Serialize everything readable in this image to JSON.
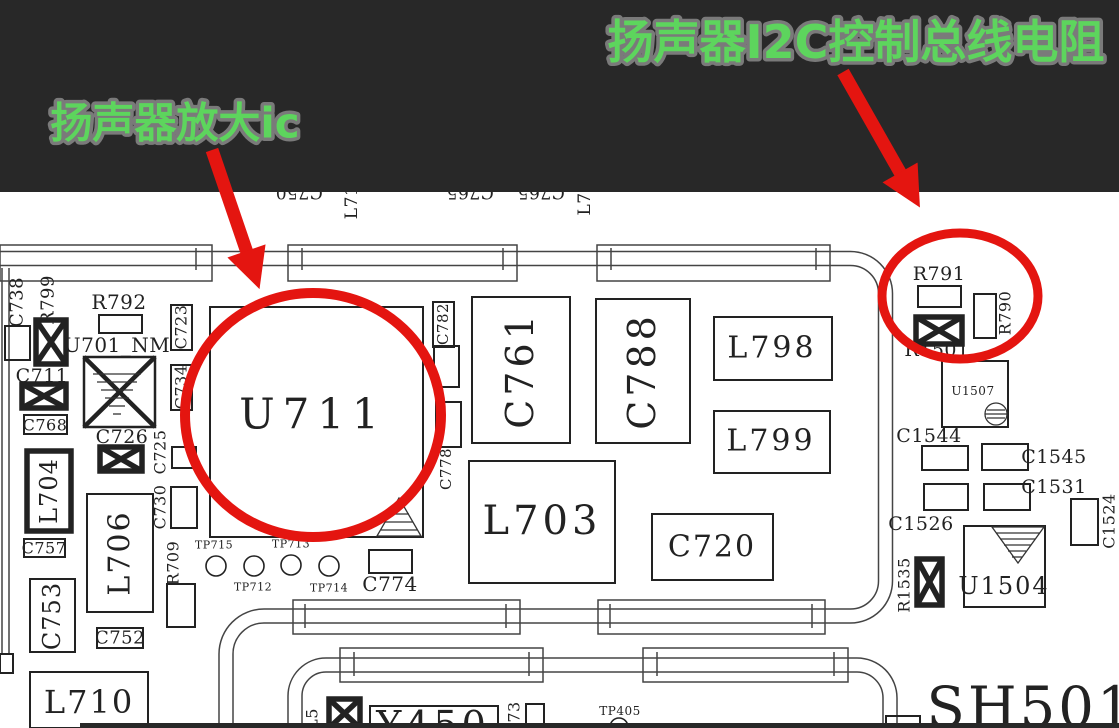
{
  "banner": {
    "left_label": "扬声器放大ic",
    "right_label": "扬声器I2C控制总线电阻",
    "bg": "#282828",
    "text_color": "#5dd55d",
    "outline_color": "#7a7a7a"
  },
  "pcb": {
    "bg": "#ffffff",
    "ink": "#222222",
    "trace_ink": "#444444",
    "pipes": [
      "M 0 258.5 H 850.5 A 35 35 0 0 1 885.5 293.5 V 581 A 35 35 0 0 1 850.5 616 H 264 A 38 38 0 0 0 226 654 V 728",
      "M 295 728 V 696 A 31 31 0 0 1 326 665 H 857 A 33 33 0 0 1 890 698 V 728"
    ],
    "bus_rects": [
      {
        "x": 0,
        "y": 245,
        "w": 212,
        "h": 36
      },
      {
        "x": 288,
        "y": 245,
        "w": 229,
        "h": 36
      },
      {
        "x": 597,
        "y": 245,
        "w": 233,
        "h": 36
      },
      {
        "x": 293,
        "y": 600,
        "w": 227,
        "h": 34
      },
      {
        "x": 598,
        "y": 600,
        "w": 227,
        "h": 34
      },
      {
        "x": 340,
        "y": 648,
        "w": 203,
        "h": 34
      },
      {
        "x": 643,
        "y": 648,
        "w": 205,
        "h": 34
      }
    ],
    "bus_ticks": [
      {
        "x": 196,
        "y1": 248,
        "y2": 270
      },
      {
        "x": 302,
        "y1": 248,
        "y2": 270
      },
      {
        "x": 503,
        "y1": 248,
        "y2": 270
      },
      {
        "x": 611,
        "y1": 248,
        "y2": 270
      },
      {
        "x": 816,
        "y1": 248,
        "y2": 270
      },
      {
        "x": 305,
        "y1": 604,
        "y2": 628
      },
      {
        "x": 506,
        "y1": 604,
        "y2": 628
      },
      {
        "x": 610,
        "y1": 604,
        "y2": 628
      },
      {
        "x": 812,
        "y1": 604,
        "y2": 628
      },
      {
        "x": 354,
        "y1": 652,
        "y2": 676
      },
      {
        "x": 529,
        "y1": 652,
        "y2": 676
      },
      {
        "x": 657,
        "y1": 652,
        "y2": 676
      },
      {
        "x": 834,
        "y1": 652,
        "y2": 676
      }
    ],
    "lines": [
      {
        "x1": 2,
        "y1": 268,
        "x2": 2,
        "y2": 655
      },
      {
        "x1": 9,
        "y1": 268,
        "x2": 9,
        "y2": 655
      }
    ],
    "boxes": [
      {
        "x": 5,
        "y": 326,
        "w": 25,
        "h": 34
      },
      {
        "x": 99,
        "y": 315,
        "w": 43,
        "h": 18
      },
      {
        "x": 24,
        "y": 415,
        "w": 43,
        "h": 19
      },
      {
        "x": 171,
        "y": 305,
        "w": 21,
        "h": 45
      },
      {
        "x": 171,
        "y": 365,
        "w": 21,
        "h": 45
      },
      {
        "x": 172,
        "y": 447,
        "w": 24,
        "h": 21
      },
      {
        "x": 24,
        "y": 539,
        "w": 41,
        "h": 18
      },
      {
        "x": 30,
        "y": 579,
        "w": 45,
        "h": 73
      },
      {
        "x": 87,
        "y": 494,
        "w": 66,
        "h": 118
      },
      {
        "x": 171,
        "y": 487,
        "w": 26,
        "h": 41
      },
      {
        "x": 167,
        "y": 584,
        "w": 28,
        "h": 43
      },
      {
        "x": 97,
        "y": 628,
        "w": 46,
        "h": 20
      },
      {
        "x": 30,
        "y": 672,
        "w": 118,
        "h": 56
      },
      {
        "x": 27,
        "y": 451,
        "w": 44,
        "h": 80,
        "lw": 5.5
      },
      {
        "x": 210,
        "y": 307,
        "w": 213,
        "h": 230
      },
      {
        "x": 369,
        "y": 550,
        "w": 43,
        "h": 23
      },
      {
        "x": 433,
        "y": 302,
        "w": 21,
        "h": 45
      },
      {
        "x": 434,
        "y": 346,
        "w": 25,
        "h": 41
      },
      {
        "x": 436,
        "y": 402,
        "w": 25,
        "h": 45
      },
      {
        "x": 472,
        "y": 297,
        "w": 98,
        "h": 146
      },
      {
        "x": 596,
        "y": 299,
        "w": 94,
        "h": 144
      },
      {
        "x": 469,
        "y": 461,
        "w": 146,
        "h": 122
      },
      {
        "x": 652,
        "y": 514,
        "w": 121,
        "h": 66
      },
      {
        "x": 714,
        "y": 317,
        "w": 118,
        "h": 63
      },
      {
        "x": 714,
        "y": 411,
        "w": 116,
        "h": 62
      },
      {
        "x": 918,
        "y": 286,
        "w": 43,
        "h": 21
      },
      {
        "x": 974,
        "y": 294,
        "w": 22,
        "h": 44
      },
      {
        "x": 942,
        "y": 361,
        "w": 66,
        "h": 66
      },
      {
        "x": 922,
        "y": 446,
        "w": 46,
        "h": 24
      },
      {
        "x": 924,
        "y": 484,
        "w": 44,
        "h": 26
      },
      {
        "x": 982,
        "y": 444,
        "w": 46,
        "h": 26
      },
      {
        "x": 984,
        "y": 484,
        "w": 46,
        "h": 26
      },
      {
        "x": 1071,
        "y": 499,
        "w": 27,
        "h": 46
      },
      {
        "x": 964,
        "y": 526,
        "w": 81,
        "h": 81
      },
      {
        "x": 370,
        "y": 706,
        "w": 128,
        "h": 40
      },
      {
        "x": 526,
        "y": 704,
        "w": 18,
        "h": 24
      },
      {
        "x": 886,
        "y": 716,
        "w": 34,
        "h": 12
      },
      {
        "x": 0,
        "y": 654,
        "w": 13,
        "h": 19
      }
    ],
    "xboxes": [
      {
        "x": 36,
        "y": 320,
        "w": 30,
        "h": 44,
        "rw": 5.5,
        "xw": 5.5
      },
      {
        "x": 84,
        "y": 357,
        "w": 71,
        "h": 70,
        "rw": 2.5,
        "xw": 4.5
      },
      {
        "x": 22,
        "y": 384,
        "w": 44,
        "h": 24,
        "rw": 5.5,
        "xw": 5.5
      },
      {
        "x": 100,
        "y": 447,
        "w": 42,
        "h": 24,
        "rw": 5.5,
        "xw": 5.5
      },
      {
        "x": 916,
        "y": 317,
        "w": 46,
        "h": 27,
        "rw": 5.5,
        "xw": 5.5
      },
      {
        "x": 917,
        "y": 559,
        "w": 25,
        "h": 46,
        "rw": 5.5,
        "xw": 5.5
      },
      {
        "x": 329,
        "y": 699,
        "w": 31,
        "h": 29,
        "rw": 5.5,
        "xw": 5.5
      }
    ],
    "labels": [
      {
        "t": "C750",
        "x": 299,
        "y": 192,
        "fs": 17,
        "r": 180
      },
      {
        "t": "L71",
        "x": 352,
        "y": 202,
        "fs": 17,
        "r": -90
      },
      {
        "t": "C765",
        "x": 470,
        "y": 192,
        "fs": 17,
        "r": 180
      },
      {
        "t": "C765",
        "x": 541,
        "y": 192,
        "fs": 17,
        "r": 180
      },
      {
        "t": "L7",
        "x": 585,
        "y": 204,
        "fs": 17,
        "r": -90
      },
      {
        "t": "C738",
        "x": 17,
        "y": 302,
        "fs": 18,
        "r": -90
      },
      {
        "t": "R799",
        "x": 48,
        "y": 300,
        "fs": 18,
        "r": -90
      },
      {
        "t": "R792",
        "x": 119,
        "y": 302,
        "fs": 20,
        "r": 0
      },
      {
        "t": "U701_NM",
        "x": 117,
        "y": 345,
        "fs": 20,
        "r": 0
      },
      {
        "t": "C711",
        "x": 42,
        "y": 376,
        "fs": 19,
        "r": 0
      },
      {
        "t": "C768",
        "x": 45,
        "y": 425,
        "fs": 16,
        "r": 0
      },
      {
        "t": "C723",
        "x": 181,
        "y": 327,
        "fs": 16,
        "r": -90
      },
      {
        "t": "C734",
        "x": 181,
        "y": 387,
        "fs": 16,
        "r": -90
      },
      {
        "t": "C726",
        "x": 122,
        "y": 437,
        "fs": 19,
        "r": 0
      },
      {
        "t": "C725",
        "x": 160,
        "y": 452,
        "fs": 16,
        "r": -90
      },
      {
        "t": "L704",
        "x": 49,
        "y": 491,
        "fs": 24,
        "r": -90,
        "ls": 1
      },
      {
        "t": "C757",
        "x": 44,
        "y": 548,
        "fs": 16,
        "r": 0
      },
      {
        "t": "C753",
        "x": 52,
        "y": 616,
        "fs": 24,
        "r": -90,
        "ls": 1
      },
      {
        "t": "L706",
        "x": 120,
        "y": 553,
        "fs": 30,
        "r": -90,
        "ls": 2
      },
      {
        "t": "C730",
        "x": 160,
        "y": 507,
        "fs": 16,
        "r": -90
      },
      {
        "t": "R709",
        "x": 173,
        "y": 563,
        "fs": 16,
        "r": -90
      },
      {
        "t": "C752",
        "x": 120,
        "y": 638,
        "fs": 18,
        "r": 0
      },
      {
        "t": "L710",
        "x": 89,
        "y": 702,
        "fs": 32,
        "r": 0,
        "ls": 2
      },
      {
        "t": "U711",
        "x": 313,
        "y": 414,
        "fs": 42,
        "r": 0,
        "ls": 8
      },
      {
        "t": "TP715",
        "x": 214,
        "y": 545,
        "fs": 11,
        "r": 0
      },
      {
        "t": "TP712",
        "x": 253,
        "y": 587,
        "fs": 11,
        "r": 0
      },
      {
        "t": "TP713",
        "x": 291,
        "y": 544,
        "fs": 11,
        "r": 0
      },
      {
        "t": "TP714",
        "x": 329,
        "y": 588,
        "fs": 11,
        "r": 0
      },
      {
        "t": "C774",
        "x": 390,
        "y": 584,
        "fs": 20,
        "r": 0
      },
      {
        "t": "C782",
        "x": 443,
        "y": 324,
        "fs": 15,
        "r": -90
      },
      {
        "t": "C778",
        "x": 446,
        "y": 469,
        "fs": 15,
        "r": -90
      },
      {
        "t": "C761",
        "x": 520,
        "y": 370,
        "fs": 38,
        "r": -90,
        "ls": 4
      },
      {
        "t": "C788",
        "x": 642,
        "y": 371,
        "fs": 38,
        "r": -90,
        "ls": 4
      },
      {
        "t": "L703",
        "x": 542,
        "y": 521,
        "fs": 40,
        "r": 0,
        "ls": 4
      },
      {
        "t": "C720",
        "x": 712,
        "y": 547,
        "fs": 30,
        "r": 0,
        "ls": 2
      },
      {
        "t": "L798",
        "x": 772,
        "y": 348,
        "fs": 30,
        "r": 0,
        "ls": 3
      },
      {
        "t": "L799",
        "x": 771,
        "y": 441,
        "fs": 30,
        "r": 0,
        "ls": 3
      },
      {
        "t": "R791",
        "x": 939,
        "y": 274,
        "fs": 19,
        "r": 0
      },
      {
        "t": "R790",
        "x": 1005,
        "y": 313,
        "fs": 16,
        "r": -90
      },
      {
        "t": "R1501",
        "x": 937,
        "y": 350,
        "fs": 19,
        "r": 0
      },
      {
        "t": "U1507",
        "x": 973,
        "y": 391,
        "fs": 12,
        "r": 0
      },
      {
        "t": "C1544",
        "x": 929,
        "y": 436,
        "fs": 19,
        "r": 0
      },
      {
        "t": "C1545",
        "x": 1054,
        "y": 457,
        "fs": 19,
        "r": 0
      },
      {
        "t": "C1531",
        "x": 1054,
        "y": 487,
        "fs": 19,
        "r": 0
      },
      {
        "t": "C1526",
        "x": 921,
        "y": 524,
        "fs": 19,
        "r": 0
      },
      {
        "t": "C1524",
        "x": 1109,
        "y": 521,
        "fs": 16,
        "r": -90
      },
      {
        "t": "R1535",
        "x": 904,
        "y": 585,
        "fs": 16,
        "r": -90
      },
      {
        "t": "U1504",
        "x": 1004,
        "y": 586,
        "fs": 24,
        "r": 0,
        "ls": 2
      },
      {
        "t": "SH501",
        "x": 1031,
        "y": 708,
        "fs": 56,
        "r": 0,
        "ls": 3
      },
      {
        "t": "L5",
        "x": 312,
        "y": 719,
        "fs": 16,
        "r": -90
      },
      {
        "t": "Y450",
        "x": 433,
        "y": 725,
        "fs": 38,
        "r": 0,
        "ls": 4
      },
      {
        "t": "73",
        "x": 514,
        "y": 712,
        "fs": 16,
        "r": -90
      },
      {
        "t": "TP405",
        "x": 620,
        "y": 711,
        "fs": 12,
        "r": 0
      }
    ],
    "circles": [
      {
        "cx": 216,
        "cy": 566,
        "r": 10
      },
      {
        "cx": 254,
        "cy": 566,
        "r": 10
      },
      {
        "cx": 291,
        "cy": 565,
        "r": 10
      },
      {
        "cx": 329,
        "cy": 566,
        "r": 10
      },
      {
        "cx": 619,
        "cy": 727,
        "r": 9
      }
    ]
  },
  "highlight": {
    "color": "#e41510",
    "circles": [
      {
        "cx": 313,
        "cy": 415,
        "rx": 128,
        "ry": 122,
        "sw": 10
      },
      {
        "cx": 960,
        "cy": 296,
        "rx": 78,
        "ry": 63,
        "sw": 9
      }
    ],
    "arrows": [
      {
        "x1": 212,
        "y1": 150,
        "x2": 253,
        "y2": 270
      },
      {
        "x1": 843,
        "y1": 72,
        "x2": 910,
        "y2": 190
      }
    ]
  }
}
